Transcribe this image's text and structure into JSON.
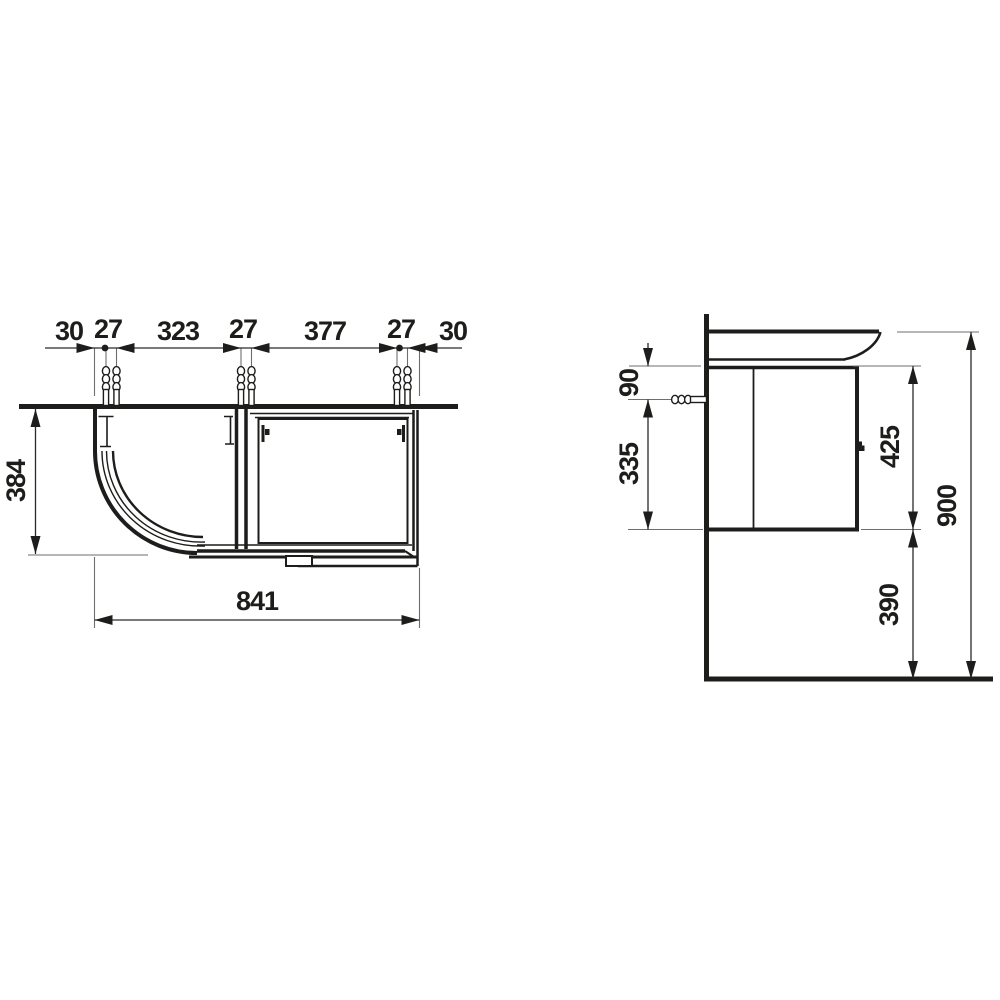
{
  "figure": {
    "type": "technical dimension drawing",
    "subject": "corner washbasin vanity unit, plan view and side view",
    "colors": {
      "line": "#1d1d1b",
      "extension": "#7a7a7a",
      "background": "#ffffff"
    },
    "plan_view": {
      "top_dimensions": [
        "30",
        "27",
        "323",
        "27",
        "377",
        "27",
        "30"
      ],
      "depth": "384",
      "width": "841"
    },
    "side_view": {
      "anchor_offset": "90",
      "anchor_to_bottom": "335",
      "cabinet_height": "425",
      "floor_clearance": "390",
      "total_height": "900"
    }
  }
}
